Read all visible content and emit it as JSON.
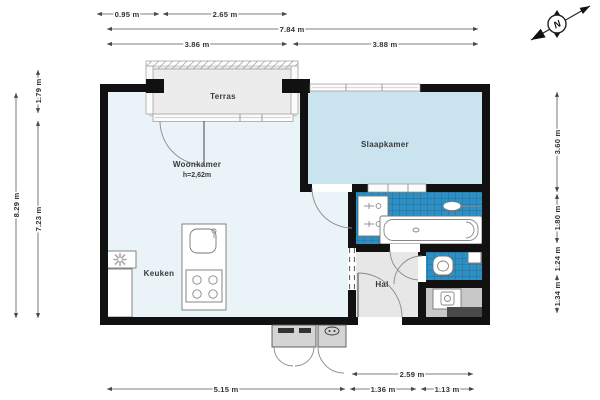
{
  "rooms": {
    "terras": "Terras",
    "woonkamer": "Woonkamer",
    "woonkamer_height": "h=2,62m",
    "slaapkamer": "Slaapkamer",
    "keuken": "Keuken",
    "hal": "Hal"
  },
  "compass": {
    "north_label": "N"
  },
  "dimensions": {
    "top_row1": [
      "0.95 m",
      "2.65 m"
    ],
    "top_row2": [
      "7.84 m"
    ],
    "top_row3": [
      "3.86 m",
      "3.88 m"
    ],
    "left_outer": "8.29 m",
    "left_inner": [
      "1.79 m",
      "7.23 m"
    ],
    "right": [
      "3.60 m",
      "1.80 m",
      "1.24 m",
      "1.34 m"
    ],
    "bottom_row1": "2.59 m",
    "bottom_row2": [
      "5.15 m",
      "1.36 m",
      "1.13 m"
    ]
  },
  "colors": {
    "wall": "#111111",
    "woonkamer_floor": "#e9f3f8",
    "slaapkamer_floor": "#c9e4ef",
    "tile_blue": "#2e8fc2",
    "tile_grid": "#1d6fa0",
    "terras_floor": "#ececec",
    "hal_floor": "#e7e7e7",
    "utility_floor": "#c8c8c8",
    "counter_dark": "#4a4a4a"
  }
}
